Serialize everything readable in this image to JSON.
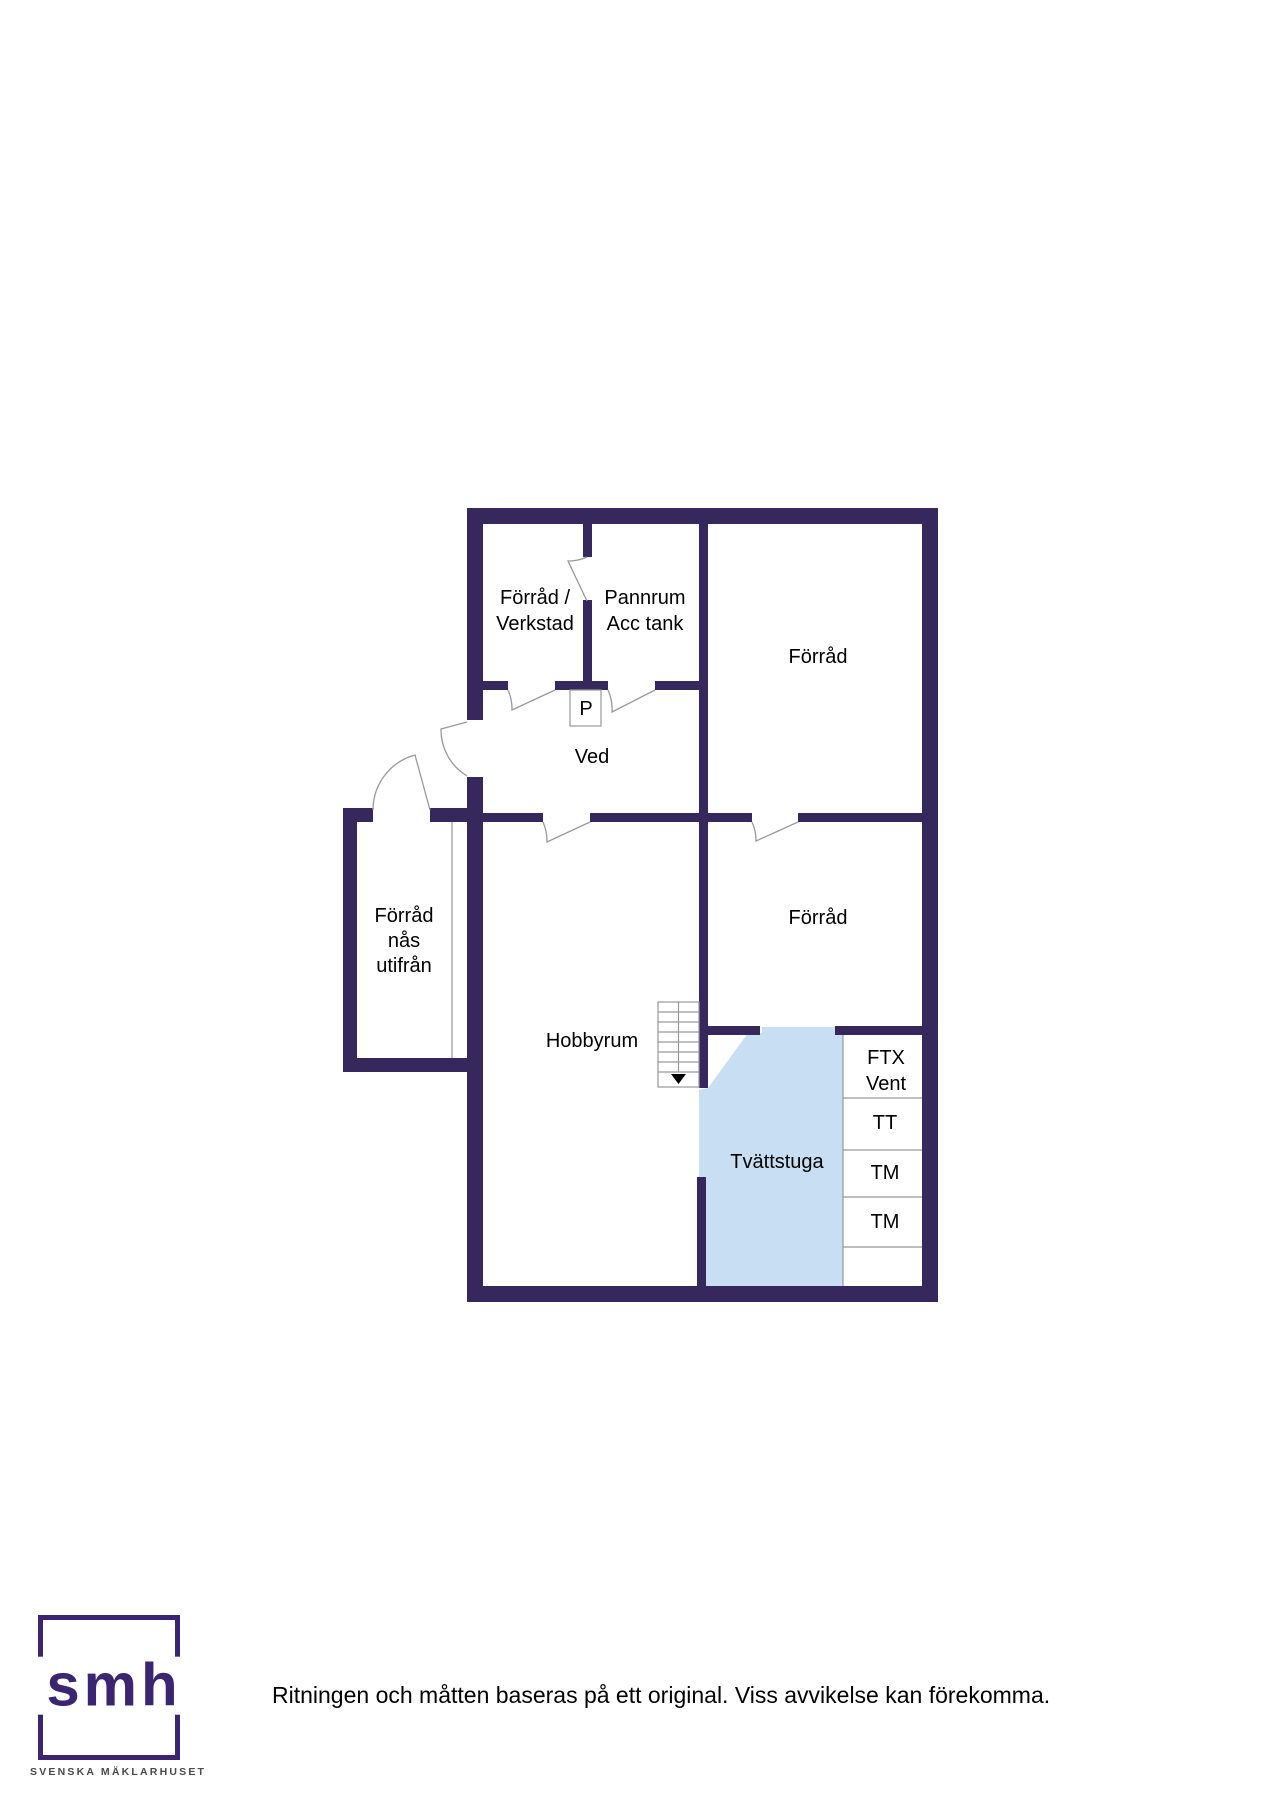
{
  "floorplan": {
    "colors": {
      "wall": "#36275d",
      "laundry_fill": "#c8def2",
      "line": "#999999"
    },
    "rooms": {
      "forrad_verkstad": {
        "line1": "Förråd /",
        "line2": "Verkstad"
      },
      "pannrum": {
        "line1": "Pannrum",
        "line2": "Acc tank"
      },
      "forrad_top": {
        "label": "Förråd"
      },
      "p_box": {
        "label": "P"
      },
      "ved": {
        "label": "Ved"
      },
      "forrad_utifran": {
        "line1": "Förråd",
        "line2": "nås",
        "line3": "utifrån"
      },
      "hobbyrum": {
        "label": "Hobbyrum"
      },
      "forrad_mid": {
        "label": "Förråd"
      },
      "tvattstuga": {
        "label": "Tvättstuga"
      },
      "ftx_vent": {
        "line1": "FTX",
        "line2": "Vent"
      },
      "tt": {
        "label": "TT"
      },
      "tm_upper": {
        "label": "TM"
      },
      "tm_lower": {
        "label": "TM"
      }
    }
  },
  "footer": {
    "logo_text": "smh",
    "logo_subtext": "SVENSKA MÄKLARHUSET",
    "logo_color": "#3b2470",
    "disclaimer": "Ritningen och måtten baseras på ett original. Viss avvikelse kan förekomma."
  }
}
